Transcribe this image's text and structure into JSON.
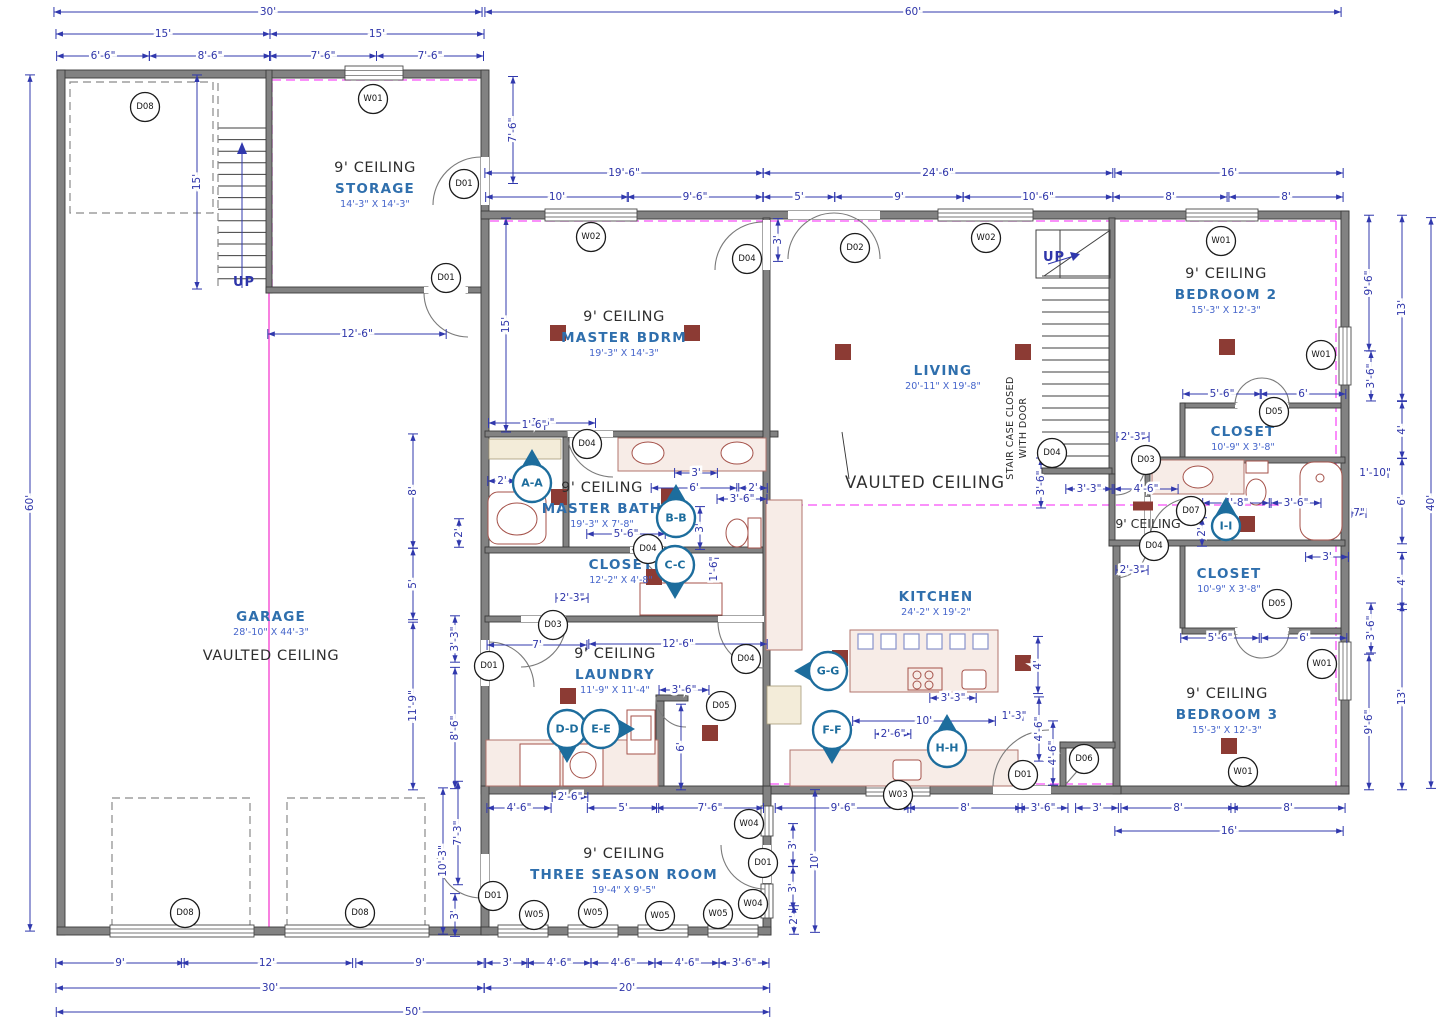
{
  "rooms": [
    {
      "id": "storage",
      "ceiling": "9' CEILING",
      "name": "STORAGE",
      "size": "14'-3\" X 14'-3\"",
      "x": 375,
      "y": 172
    },
    {
      "id": "master-bdrm",
      "ceiling": "9' CEILING",
      "name": "MASTER BDRM",
      "size": "19'-3\" X 14'-3\"",
      "x": 624,
      "y": 321
    },
    {
      "id": "living",
      "name": "LIVING",
      "size": "20'-11\" X 19'-8\"",
      "x": 943,
      "y": 375
    },
    {
      "id": "bedroom-2",
      "ceiling": "9' CEILING",
      "name": "BEDROOM 2",
      "size": "15'-3\" X 12'-3\"",
      "x": 1226,
      "y": 278
    },
    {
      "id": "garage",
      "name": "GARAGE",
      "size": "28'-10\" X 44'-3\"",
      "x": 271,
      "y": 621
    },
    {
      "id": "master-bath",
      "ceiling": "9' CEILING",
      "name": "MASTER BATH",
      "size": "19'-3\" X 7'-8\"",
      "x": 602,
      "y": 492
    },
    {
      "id": "master-closet",
      "name": "CLOSET",
      "size": "12'-2\" X 4'-8\"",
      "x": 621,
      "y": 569
    },
    {
      "id": "kitchen",
      "name": "KITCHEN",
      "size": "24'-2\" X 19'-2\"",
      "x": 936,
      "y": 601
    },
    {
      "id": "laundry",
      "ceiling": "9' CEILING",
      "name": "LAUNDRY",
      "size": "11'-9\" X 11'-4\"",
      "x": 615,
      "y": 658
    },
    {
      "id": "bedroom2-closet",
      "name": "CLOSET",
      "size": "10'-9\" X 3'-8\"",
      "x": 1243,
      "y": 436
    },
    {
      "id": "bedroom3-closet",
      "name": "CLOSET",
      "size": "10'-9\" X 3'-8\"",
      "x": 1229,
      "y": 578
    },
    {
      "id": "bedroom-3",
      "ceiling": "9' CEILING",
      "name": "BEDROOM 3",
      "size": "15'-3\" X 12'-3\"",
      "x": 1227,
      "y": 698
    },
    {
      "id": "three-season",
      "ceiling": "9' CEILING",
      "name": "THREE SEASON ROOM",
      "size": "19'-4\" X 9'-5\"",
      "x": 624,
      "y": 858
    }
  ],
  "notes": [
    {
      "t": "VAULTED CEILING",
      "c": "ceil17",
      "x": 925,
      "y": 488
    },
    {
      "t": "VAULTED CEILING",
      "c": "ceil",
      "x": 271,
      "y": 660
    },
    {
      "t": "9' CEILING",
      "c": "ceil13",
      "x": 1148,
      "y": 528
    },
    {
      "t": "UP",
      "c": "up",
      "x": 244,
      "y": 286
    },
    {
      "t": "UP",
      "c": "up",
      "x": 1054,
      "y": 261
    },
    {
      "t": "STAIR CASE CLOSED",
      "c": "vnote",
      "x": 1013,
      "y": 428,
      "v": 1
    },
    {
      "t": "WITH DOOR",
      "c": "vnote",
      "x": 1026,
      "y": 428,
      "v": 1
    }
  ],
  "dims": [
    {
      "t": "30'",
      "x": 268,
      "y": 12
    },
    {
      "t": "60'",
      "x": 913,
      "y": 12
    },
    {
      "t": "15'",
      "x": 163,
      "y": 34
    },
    {
      "t": "15'",
      "x": 377,
      "y": 34
    },
    {
      "t": "6'-6\"",
      "x": 103,
      "y": 56
    },
    {
      "t": "8'-6\"",
      "x": 210,
      "y": 56
    },
    {
      "t": "7'-6\"",
      "x": 323,
      "y": 56
    },
    {
      "t": "7'-6\"",
      "x": 430,
      "y": 56
    },
    {
      "t": "19'-6\"",
      "x": 624,
      "y": 173
    },
    {
      "t": "24'-6\"",
      "x": 938,
      "y": 173
    },
    {
      "t": "16'",
      "x": 1229,
      "y": 173
    },
    {
      "t": "10'",
      "x": 557,
      "y": 197
    },
    {
      "t": "9'-6\"",
      "x": 695,
      "y": 197
    },
    {
      "t": "5'",
      "x": 799,
      "y": 197
    },
    {
      "t": "9'",
      "x": 899,
      "y": 197
    },
    {
      "t": "10'-6\"",
      "x": 1038,
      "y": 197
    },
    {
      "t": "8'",
      "x": 1170,
      "y": 197
    },
    {
      "t": "8'",
      "x": 1286,
      "y": 197
    },
    {
      "t": "7'-6\"",
      "x": 513,
      "y": 130,
      "v": 1
    },
    {
      "t": "15'",
      "x": 197,
      "y": 182,
      "v": 1
    },
    {
      "t": "3'",
      "x": 778,
      "y": 240,
      "v": 1
    },
    {
      "t": "12'-6\"",
      "x": 357,
      "y": 334
    },
    {
      "t": "15'",
      "x": 506,
      "y": 325,
      "v": 1
    },
    {
      "t": "7'-6\"",
      "x": 542,
      "y": 423
    },
    {
      "t": "9'-6\"",
      "x": 1369,
      "y": 283,
      "v": 1
    },
    {
      "t": "13'",
      "x": 1402,
      "y": 308,
      "v": 1
    },
    {
      "t": "3'-6\"",
      "x": 1371,
      "y": 376,
      "v": 1
    },
    {
      "t": "4'",
      "x": 1402,
      "y": 430,
      "v": 1
    },
    {
      "t": "1'-10\"",
      "x": 1375,
      "y": 473
    },
    {
      "t": "6'",
      "x": 1402,
      "y": 501,
      "v": 1
    },
    {
      "t": "40'",
      "x": 1431,
      "y": 503,
      "v": 1
    },
    {
      "t": "7\"",
      "x": 1359,
      "y": 513
    },
    {
      "t": "4'",
      "x": 1402,
      "y": 581,
      "v": 1
    },
    {
      "t": "3'-6\"",
      "x": 1371,
      "y": 628,
      "v": 1
    },
    {
      "t": "13'",
      "x": 1402,
      "y": 697,
      "v": 1
    },
    {
      "t": "9'-6\"",
      "x": 1369,
      "y": 722,
      "v": 1
    },
    {
      "t": "2'-3\"",
      "x": 1133,
      "y": 437
    },
    {
      "t": "5'-6\"",
      "x": 1222,
      "y": 394
    },
    {
      "t": "6'",
      "x": 1303,
      "y": 394
    },
    {
      "t": "3'-3\"",
      "x": 1089,
      "y": 489
    },
    {
      "t": "4'-6\"",
      "x": 1146,
      "y": 489
    },
    {
      "t": "4'-8\"",
      "x": 1236,
      "y": 503
    },
    {
      "t": "3'-6\"",
      "x": 1296,
      "y": 503
    },
    {
      "t": "2'",
      "x": 1202,
      "y": 532,
      "v": 1
    },
    {
      "t": "2'-3\"",
      "x": 1132,
      "y": 570
    },
    {
      "t": "3'",
      "x": 1327,
      "y": 557
    },
    {
      "t": "5'-6\"",
      "x": 1220,
      "y": 638
    },
    {
      "t": "6'",
      "x": 1304,
      "y": 638
    },
    {
      "t": "3'-6\"",
      "x": 1041,
      "y": 483,
      "v": 1
    },
    {
      "t": "2'",
      "x": 502,
      "y": 481
    },
    {
      "t": "2'",
      "x": 459,
      "y": 533,
      "v": 1
    },
    {
      "t": "5'-6\"",
      "x": 626,
      "y": 534
    },
    {
      "t": "3'",
      "x": 696,
      "y": 473
    },
    {
      "t": "6'",
      "x": 694,
      "y": 488
    },
    {
      "t": "2'",
      "x": 753,
      "y": 488
    },
    {
      "t": "3'-6\"",
      "x": 742,
      "y": 499
    },
    {
      "t": "3'",
      "x": 700,
      "y": 528,
      "v": 1
    },
    {
      "t": "1'-6\"",
      "x": 714,
      "y": 569,
      "v": 1
    },
    {
      "t": "1'-6\"",
      "x": 534,
      "y": 425
    },
    {
      "t": "2'-3\"",
      "x": 572,
      "y": 598
    },
    {
      "t": "8'",
      "x": 413,
      "y": 491,
      "v": 1
    },
    {
      "t": "5'",
      "x": 413,
      "y": 584,
      "v": 1
    },
    {
      "t": "3'-3\"",
      "x": 455,
      "y": 639,
      "v": 1
    },
    {
      "t": "11'-9\"",
      "x": 413,
      "y": 706,
      "v": 1
    },
    {
      "t": "8'-6\"",
      "x": 455,
      "y": 728,
      "v": 1
    },
    {
      "t": "10'-3\"",
      "x": 443,
      "y": 861,
      "v": 1
    },
    {
      "t": "7'-3\"",
      "x": 458,
      "y": 833,
      "v": 1
    },
    {
      "t": "3'",
      "x": 455,
      "y": 915,
      "v": 1
    },
    {
      "t": "60'",
      "x": 30,
      "y": 503,
      "v": 1
    },
    {
      "t": "7'",
      "x": 537,
      "y": 645
    },
    {
      "t": "12'-6\"",
      "x": 678,
      "y": 644
    },
    {
      "t": "3'-6\"",
      "x": 684,
      "y": 690
    },
    {
      "t": "6'",
      "x": 681,
      "y": 747,
      "v": 1
    },
    {
      "t": "2'-6\"",
      "x": 570,
      "y": 797
    },
    {
      "t": "4'-6\"",
      "x": 519,
      "y": 808
    },
    {
      "t": "5'",
      "x": 623,
      "y": 808
    },
    {
      "t": "7'-6\"",
      "x": 710,
      "y": 808
    },
    {
      "t": "4'",
      "x": 1038,
      "y": 665,
      "v": 1
    },
    {
      "t": "3'-3\"",
      "x": 953,
      "y": 698
    },
    {
      "t": "10'",
      "x": 924,
      "y": 721
    },
    {
      "t": "1'-3\"",
      "x": 1014,
      "y": 716
    },
    {
      "t": "4'-6\"",
      "x": 1039,
      "y": 729,
      "v": 1
    },
    {
      "t": "2'-6\"",
      "x": 893,
      "y": 734
    },
    {
      "t": "4'-6\"",
      "x": 1053,
      "y": 753,
      "v": 1
    },
    {
      "t": "9'-6\"",
      "x": 843,
      "y": 808
    },
    {
      "t": "8'",
      "x": 965,
      "y": 808
    },
    {
      "t": "3'-6\"",
      "x": 1043,
      "y": 808
    },
    {
      "t": "3'",
      "x": 1097,
      "y": 808
    },
    {
      "t": "8'",
      "x": 1178,
      "y": 808
    },
    {
      "t": "8'",
      "x": 1288,
      "y": 808
    },
    {
      "t": "16'",
      "x": 1229,
      "y": 831
    },
    {
      "t": "3'",
      "x": 793,
      "y": 845,
      "v": 1
    },
    {
      "t": "10'",
      "x": 815,
      "y": 861,
      "v": 1
    },
    {
      "t": "3'",
      "x": 793,
      "y": 888,
      "v": 1
    },
    {
      "t": "2'",
      "x": 794,
      "y": 920,
      "v": 1
    },
    {
      "t": "9'",
      "x": 120,
      "y": 963
    },
    {
      "t": "12'",
      "x": 267,
      "y": 963
    },
    {
      "t": "9'",
      "x": 420,
      "y": 963
    },
    {
      "t": "3'",
      "x": 507,
      "y": 963
    },
    {
      "t": "4'-6\"",
      "x": 559,
      "y": 963
    },
    {
      "t": "4'-6\"",
      "x": 623,
      "y": 963
    },
    {
      "t": "4'-6\"",
      "x": 687,
      "y": 963
    },
    {
      "t": "3'-6\"",
      "x": 744,
      "y": 963
    },
    {
      "t": "30'",
      "x": 270,
      "y": 988
    },
    {
      "t": "20'",
      "x": 627,
      "y": 988
    },
    {
      "t": "50'",
      "x": 413,
      "y": 1012
    }
  ],
  "tags": [
    {
      "t": "D08",
      "x": 145,
      "y": 107
    },
    {
      "t": "W01",
      "x": 373,
      "y": 99
    },
    {
      "t": "D01",
      "x": 464,
      "y": 184
    },
    {
      "t": "D01",
      "x": 446,
      "y": 278
    },
    {
      "t": "W02",
      "x": 591,
      "y": 237
    },
    {
      "t": "D04",
      "x": 747,
      "y": 259
    },
    {
      "t": "D02",
      "x": 855,
      "y": 248
    },
    {
      "t": "W02",
      "x": 986,
      "y": 238
    },
    {
      "t": "W01",
      "x": 1221,
      "y": 241
    },
    {
      "t": "W01",
      "x": 1321,
      "y": 355
    },
    {
      "t": "D05",
      "x": 1274,
      "y": 412
    },
    {
      "t": "D03",
      "x": 1146,
      "y": 460
    },
    {
      "t": "D03",
      "x": 553,
      "y": 625
    },
    {
      "t": "D04",
      "x": 587,
      "y": 444
    },
    {
      "t": "D04",
      "x": 648,
      "y": 549
    },
    {
      "t": "D04",
      "x": 1052,
      "y": 453
    },
    {
      "t": "D07",
      "x": 1191,
      "y": 511
    },
    {
      "t": "D04",
      "x": 1154,
      "y": 546
    },
    {
      "t": "D05",
      "x": 1277,
      "y": 604
    },
    {
      "t": "W01",
      "x": 1322,
      "y": 664
    },
    {
      "t": "D01",
      "x": 489,
      "y": 666
    },
    {
      "t": "D05",
      "x": 721,
      "y": 706
    },
    {
      "t": "D04",
      "x": 746,
      "y": 659
    },
    {
      "t": "D06",
      "x": 1084,
      "y": 759
    },
    {
      "t": "D01",
      "x": 1023,
      "y": 775
    },
    {
      "t": "W03",
      "x": 898,
      "y": 795
    },
    {
      "t": "W01",
      "x": 1243,
      "y": 772
    },
    {
      "t": "D08",
      "x": 185,
      "y": 913
    },
    {
      "t": "D08",
      "x": 360,
      "y": 913
    },
    {
      "t": "D01",
      "x": 493,
      "y": 896
    },
    {
      "t": "W05",
      "x": 534,
      "y": 915
    },
    {
      "t": "W05",
      "x": 593,
      "y": 913
    },
    {
      "t": "W05",
      "x": 660,
      "y": 916
    },
    {
      "t": "W05",
      "x": 718,
      "y": 914
    },
    {
      "t": "W04",
      "x": 749,
      "y": 824
    },
    {
      "t": "D01",
      "x": 763,
      "y": 863
    },
    {
      "t": "W04",
      "x": 753,
      "y": 904
    }
  ],
  "markers": [
    {
      "t": "A-A",
      "x": 532,
      "y": 483,
      "d": "up"
    },
    {
      "t": "B-B",
      "x": 676,
      "y": 518,
      "d": "up"
    },
    {
      "t": "C-C",
      "x": 675,
      "y": 565,
      "d": "down"
    },
    {
      "t": "D-D",
      "x": 567,
      "y": 729,
      "d": "down"
    },
    {
      "t": "E-E",
      "x": 601,
      "y": 729,
      "d": "right"
    },
    {
      "t": "F-F",
      "x": 832,
      "y": 730,
      "d": "down"
    },
    {
      "t": "G-G",
      "x": 828,
      "y": 671,
      "d": "left"
    },
    {
      "t": "H-H",
      "x": 947,
      "y": 748,
      "d": "up"
    },
    {
      "t": "I-I",
      "x": 1226,
      "y": 526,
      "d": "up",
      "s": 1
    }
  ],
  "colors": {
    "dimension": "#2e35a9",
    "room_name": "#2f6fad",
    "room_size": "#4565cb",
    "ceiling_text": "#2e2e2e",
    "wall": "#828282",
    "magenta": "#f84ef8",
    "marker": "#1d6d9d",
    "ceiling_square": "#8c3b34",
    "fixture": "#a5524a"
  }
}
